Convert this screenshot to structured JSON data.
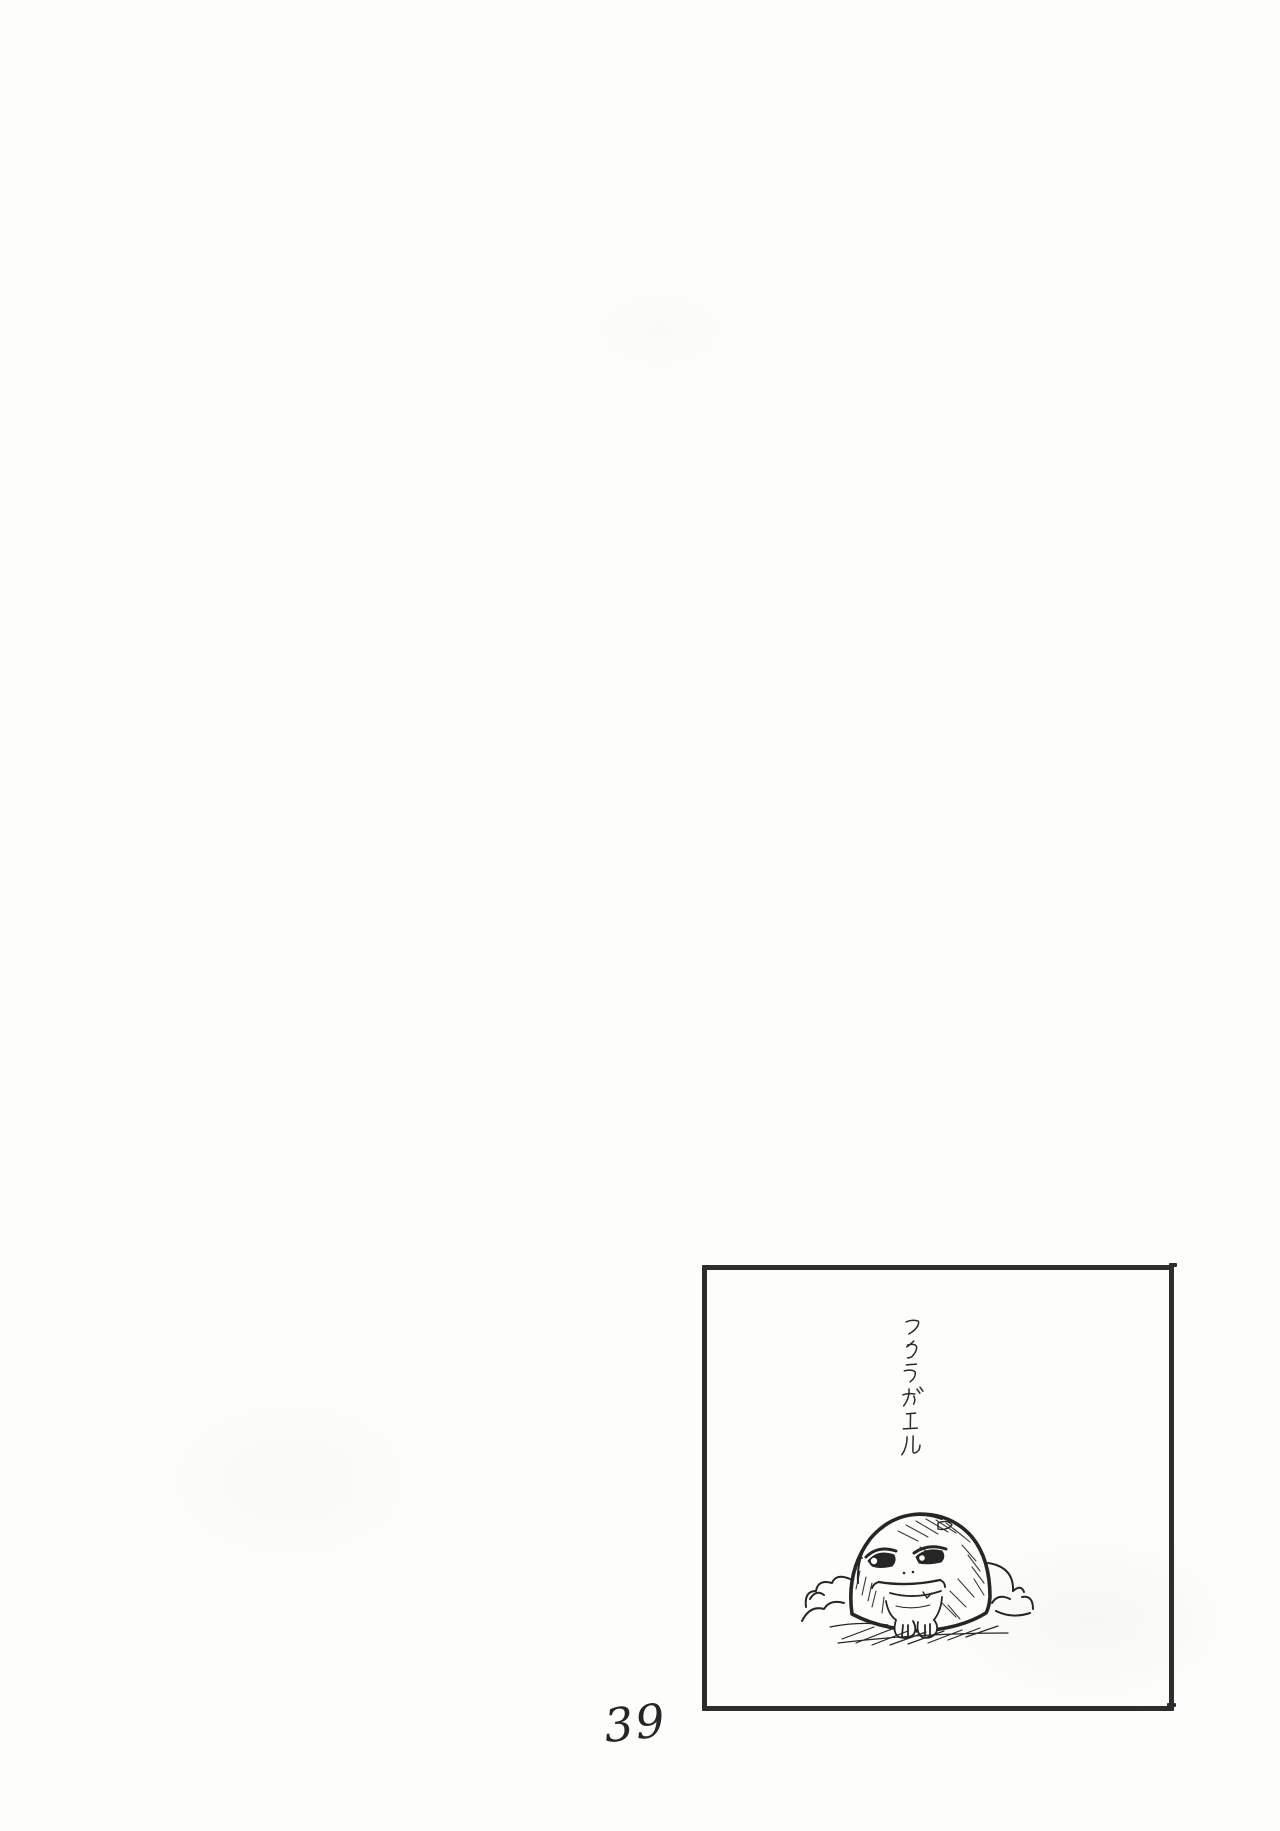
{
  "page": {
    "page_number": "39",
    "paper_color": "#fdfdfb",
    "ink_color": "#262626"
  },
  "panel": {
    "caption": "フクラガエル",
    "border_color": "#2d2d2d",
    "drawing": "round rain frog half-buried in sand mounds"
  }
}
